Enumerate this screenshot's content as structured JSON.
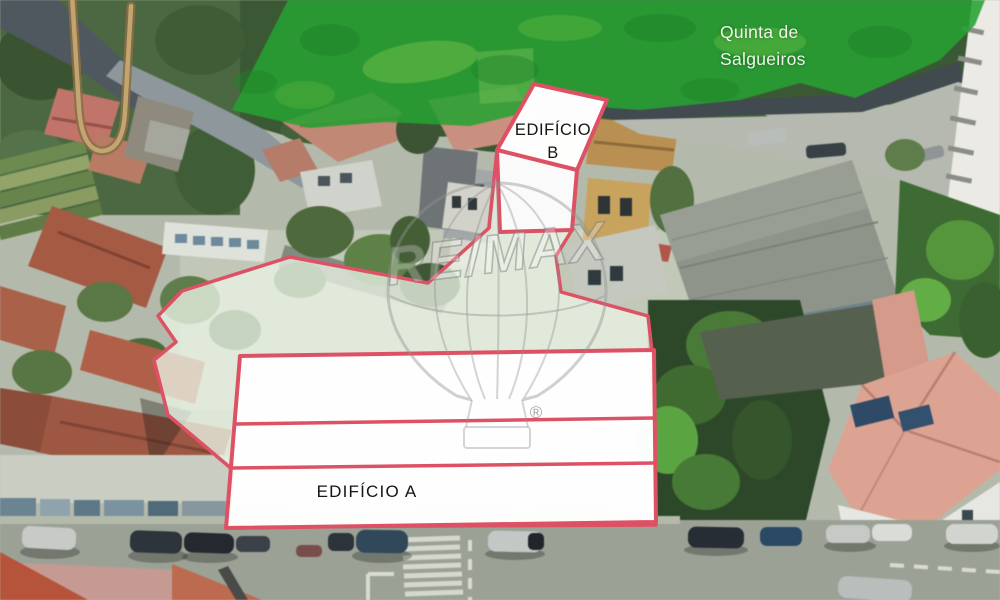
{
  "scene": {
    "description": "Aerial photograph of an urban plot with real-estate annotations",
    "area_label": {
      "line1": "Quinta de",
      "line2": "Salgueiros"
    },
    "building_b_label": {
      "line1": "EDIFÍCIO",
      "line2": "B"
    },
    "building_a_label": "EDIFÍCIO A",
    "watermark": {
      "brand": "RE/MAX",
      "registered": "®"
    },
    "colors": {
      "annotation_red": "#dd5164",
      "overlay_green": "#27a032",
      "parcel_fill": "#e9f2e4",
      "footprint_fill": "#ffffff",
      "watermark_gray": "#919191",
      "area_label_text": "#f2f3e9",
      "building_label_text": "#141414"
    }
  }
}
